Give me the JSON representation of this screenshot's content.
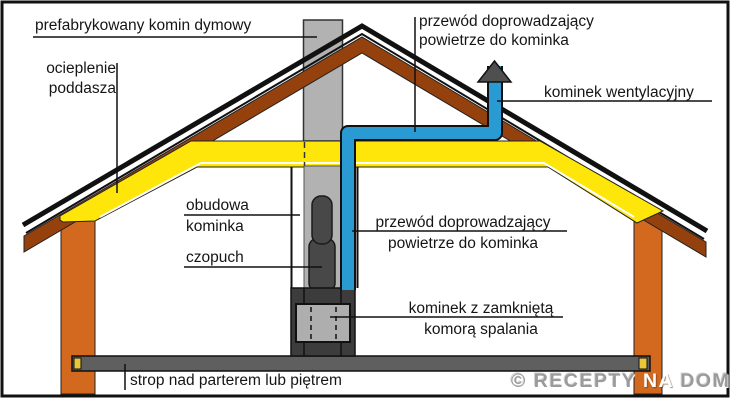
{
  "labels": {
    "chimney_label": "prefabrykowany komin dymowy",
    "attic_insulation": {
      "line1": "ocieplenie",
      "line2": "poddasza"
    },
    "air_duct_top": {
      "line1": "przewód doprowadzający",
      "line2": "powietrze do kominka"
    },
    "vent_chimney": "kominek wentylacyjny",
    "enclosure": {
      "line1": "obudowa",
      "line2": "kominka"
    },
    "flue": "czopuch",
    "air_duct_mid": {
      "line1": "przewód doprowadzający",
      "line2": "powietrze do kominka"
    },
    "fireplace": {
      "line1": "kominek z zamkniętą",
      "line2": "komorą spalania"
    },
    "floor_slab": "strop nad parterem lub piętrem"
  },
  "watermark": {
    "part1": "© RECEPTY ",
    "part2": "NA",
    "part3": " DOM"
  },
  "colors": {
    "wall_orange": "#d2691e",
    "rafter_brown": "#94410e",
    "insulation_yellow": "#ffe60a",
    "chimney_gray": "#b2b2b2",
    "flue_dark": "#484848",
    "fireplace_dark": "#3c3c3c",
    "firebox_gray": "#aeaeae",
    "slab_gray": "#5f5f5f",
    "slab_block_yellow": "#e8c83a",
    "duct_blue": "#2a9ad2",
    "vent_cap_gray": "#4f4f4f",
    "line_black": "#111111"
  }
}
